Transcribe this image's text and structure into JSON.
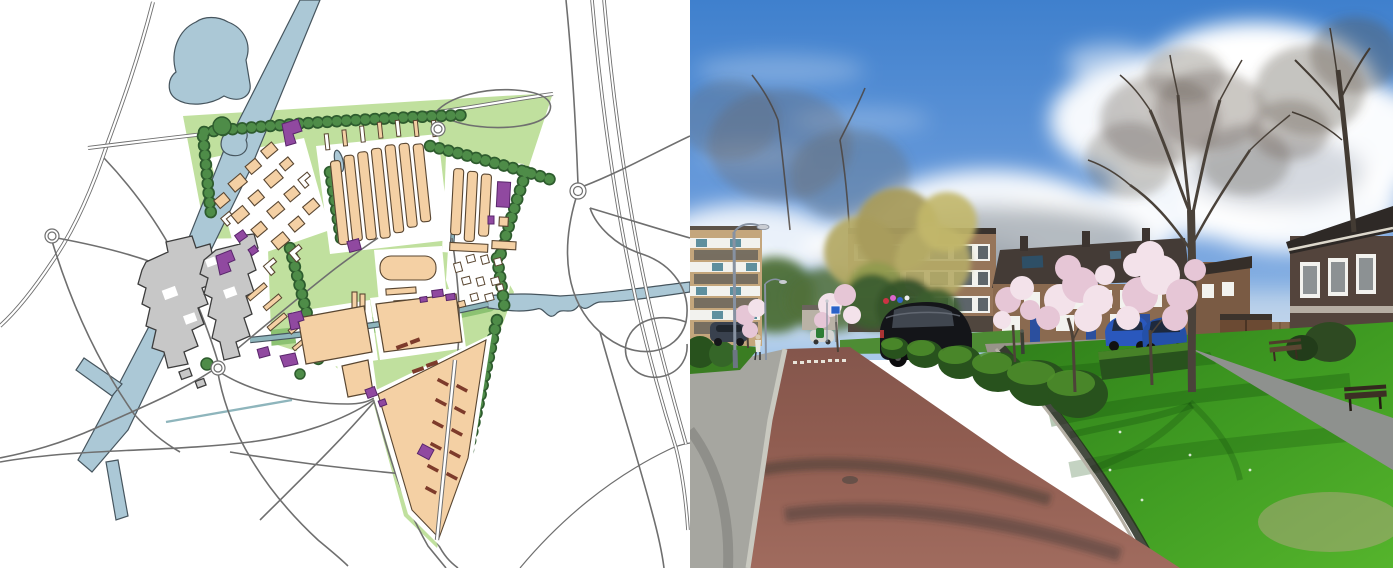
{
  "page": {
    "width": 1393,
    "height": 568,
    "kind": "masterplan map beside street photograph",
    "visible_text": ""
  },
  "panels": {
    "map": {
      "name": "urban-masterplan-drawing",
      "palette": {
        "paper": "#ffffff",
        "water_fill": "#abc8d6",
        "water_edge": "#46555e",
        "site_green": "#c0e09e",
        "bank_green": "#8cc272",
        "tree_dark": "#2e5c2e",
        "tree_mid": "#4e8c48",
        "block_tan": "#f4d0a4",
        "block_edge": "#594631",
        "village_gray": "#c7c7c7",
        "village_edge": "#3d3d3d",
        "purple": "#9049a0",
        "purple_edge": "#59266b",
        "red_brown": "#7d3b2b",
        "road": "#6f6f6f",
        "road_core": "#ffffff",
        "canal_teal": "#8eb5bc"
      },
      "features": [
        "lake",
        "canal",
        "ponds",
        "stream",
        "tree-rows",
        "housing-blocks",
        "shed-rows",
        "existing-village",
        "hamlet",
        "landmark-buildings",
        "se-district",
        "road-network",
        "highway-interchange",
        "roundabouts",
        "site-greenery"
      ]
    },
    "photo": {
      "name": "residential-street-photograph",
      "palette": {
        "sky_top": "#3f80cd",
        "sky_low": "#a8c9ea",
        "cloud_white": "#ffffff",
        "cloud_gray": "#b3bac6",
        "cloud_dark": "#8e979f",
        "far_olive": "#b5ab67",
        "leaf_dark": "#3c5e2f",
        "brick_light": "#c4a67c",
        "brick_mid": "#96755a",
        "brick_row": "#8a6a50",
        "brick_dark": "#53443c",
        "roof_dark": "#443b36",
        "window_white": "#f2f2ee",
        "glass_dark": "#39424a",
        "door_blue": "#2b4f9e",
        "blossom_light": "#f3e2ea",
        "blossom_mid": "#e6c6d6",
        "trunk": "#4d4238",
        "hedge_dark": "#28521d",
        "hedge_light": "#4f8f2c",
        "grass_light": "#55b42c",
        "grass_dark": "#2f7d1a",
        "road_brick": "#8f5c50",
        "road_brick_light": "#a06b5e",
        "sidewalk": "#a6a6a0",
        "curb_light": "#c9c9c0",
        "path_gray": "#8e918e",
        "car_black": "#141519",
        "car_blue": "#2a58bd",
        "lamp_gray": "#8792a2",
        "sign_blue": "#2b62c8",
        "sand": "#b3a583"
      },
      "features": [
        "sky",
        "cumulus-clouds",
        "bare-trees",
        "blossom-trees",
        "apartment-blocks",
        "row-houses",
        "corner-house",
        "shed-and-fence",
        "trimmed-hedges",
        "lawn",
        "brick-road",
        "sidewalk",
        "footpath",
        "street-lamps",
        "parked-cars",
        "benches",
        "bollard",
        "pedestrian"
      ]
    }
  }
}
